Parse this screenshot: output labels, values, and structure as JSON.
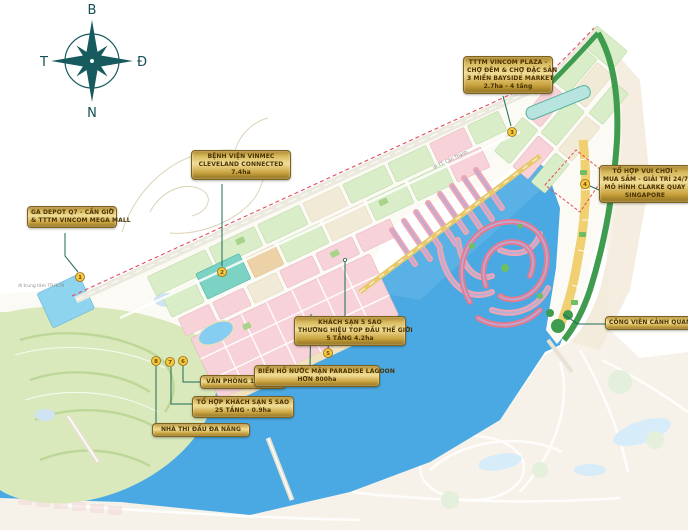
{
  "title": "Master plan map - coastal urban area (Cần Giờ)",
  "compass": {
    "north": "B",
    "south": "N",
    "west": "T",
    "east": "Đ"
  },
  "road_labels": [
    {
      "text": "đi trung tâm TP.HCM"
    },
    {
      "text": "đi TT. Cần Thạnh"
    }
  ],
  "callouts": [
    {
      "marker": "1",
      "lines": [
        "GA DEPOT Q7 - CẦN GIỜ",
        "& TTTM VINCOM MEGA MALL"
      ]
    },
    {
      "marker": "2",
      "lines": [
        "BỆNH VIỆN VINMEC",
        "CLEVELAND CONNECTED",
        "7.4ha"
      ]
    },
    {
      "marker": "3",
      "lines": [
        "TTTM VINCOM PLAZA -",
        "CHỢ ĐÊM & CHỢ ĐẶC SẢN",
        "3 MIỀN BAYSIDE MARKET",
        "2.7ha - 4 tầng"
      ]
    },
    {
      "marker": "4",
      "lines": [
        "TỔ HỢP VUI CHƠI -",
        "MUA SẮM - GIẢI TRÍ 24/7",
        "MÔ HÌNH CLARKE QUAY",
        "SINGAPORE"
      ]
    },
    {
      "marker": "5",
      "lines": [
        "KHÁCH SẠN 5 SAO",
        "THƯƠNG HIỆU TOP ĐẦU THẾ GIỚI",
        "5 TẦNG 4.2ha"
      ]
    },
    {
      "marker": "6",
      "lines": [
        "VĂN PHÒNG 15 TẦNG"
      ]
    },
    {
      "marker": "7",
      "lines": [
        "TỔ HỢP KHÁCH SẠN 5 SAO",
        "25 TẦNG - 0.9ha"
      ]
    },
    {
      "marker": "8",
      "lines": [
        "NHÀ THI ĐẤU ĐA NĂNG"
      ]
    },
    {
      "marker": "",
      "lines": [
        "BIỂN HỒ NƯỚC MẶN PARADISE LAGOON",
        "HƠN 800ha"
      ]
    },
    {
      "marker": "",
      "lines": [
        "CÔNG VIÊN CẢNH QUAN"
      ]
    }
  ],
  "map": {
    "markers": [
      {
        "number": "1"
      },
      {
        "number": "2"
      },
      {
        "number": "3"
      },
      {
        "number": "4"
      },
      {
        "number": "5"
      },
      {
        "number": "6"
      },
      {
        "number": "7"
      },
      {
        "number": "8"
      }
    ],
    "colors": {
      "water": "#4aa9e2",
      "land_green_block": "#d9edc8",
      "pink_block": "#f7d2d8",
      "cream_block": "#f1ead6",
      "teal_block": "#7cd2c3",
      "depot_blue_block": "#8fd4ef",
      "gold_callout": "#d8ba5e",
      "marker_yellow": "#f6c93e",
      "park_green": "#3f9b4e",
      "boundary_red": "#e34b5f",
      "leader_green": "#1f6b52",
      "compass_teal": "#175b5e",
      "ghost_beige": "#f6f2e9"
    }
  }
}
